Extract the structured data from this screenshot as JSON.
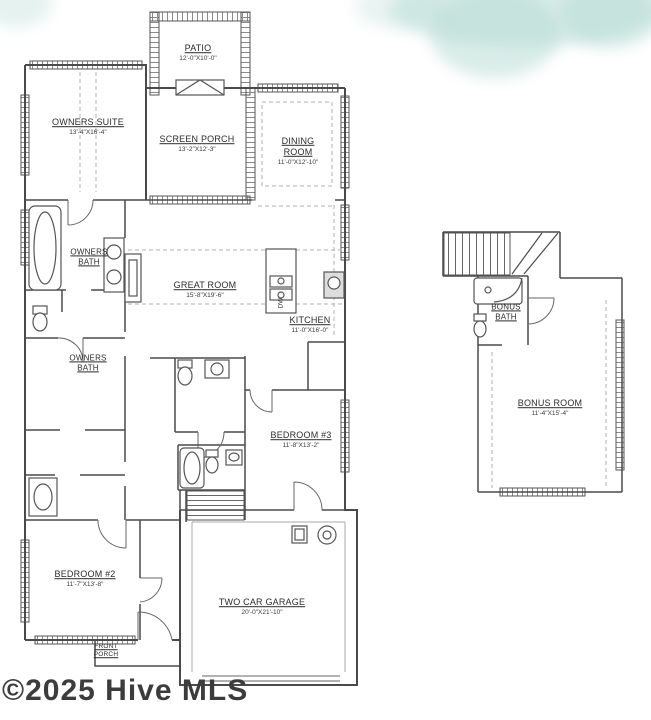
{
  "watermark": {
    "copyright": "©2025 Hive MLS"
  },
  "colors": {
    "wall": "#4a4a4a",
    "watermark_text": "#3c3c3c",
    "cloud_tint": "#acd6ce"
  },
  "plan": {
    "rooms": [
      {
        "id": "patio",
        "name": "PATIO",
        "dims": "12'-0\"X10'-0\""
      },
      {
        "id": "owners-suite",
        "name": "OWNERS SUITE",
        "dims": "13'-4\"X16'-4\""
      },
      {
        "id": "screen-porch",
        "name": "SCREEN PORCH",
        "dims": "13'-2\"X12'-3\""
      },
      {
        "id": "dining-room",
        "name": "DINING ROOM",
        "dims": "11'-0\"X12'-10\""
      },
      {
        "id": "owners-bath-upper",
        "name": "OWNERS BATH",
        "dims": ""
      },
      {
        "id": "great-room",
        "name": "GREAT ROOM",
        "dims": "15'-8\"X19'-6\""
      },
      {
        "id": "kitchen",
        "name": "KITCHEN",
        "dims": "11'-0\"X16'-0\""
      },
      {
        "id": "owners-bath-lower",
        "name": "OWNERS BATH",
        "dims": ""
      },
      {
        "id": "bedroom-3",
        "name": "BEDROOM #3",
        "dims": "11'-8\"X13'-2\""
      },
      {
        "id": "bedroom-2",
        "name": "BEDROOM #2",
        "dims": "11'-7\"X13'-8\""
      },
      {
        "id": "garage",
        "name": "TWO CAR GARAGE",
        "dims": "20'-0\"X21'-10\""
      },
      {
        "id": "front-porch",
        "name": "FRONT PORCH",
        "dims": ""
      },
      {
        "id": "bonus-bath",
        "name": "BONUS BATH",
        "dims": ""
      },
      {
        "id": "bonus-room",
        "name": "BONUS ROOM",
        "dims": "11'-4\"X15'-4\""
      }
    ],
    "appliances": {
      "dishwasher_label": "DW"
    }
  }
}
